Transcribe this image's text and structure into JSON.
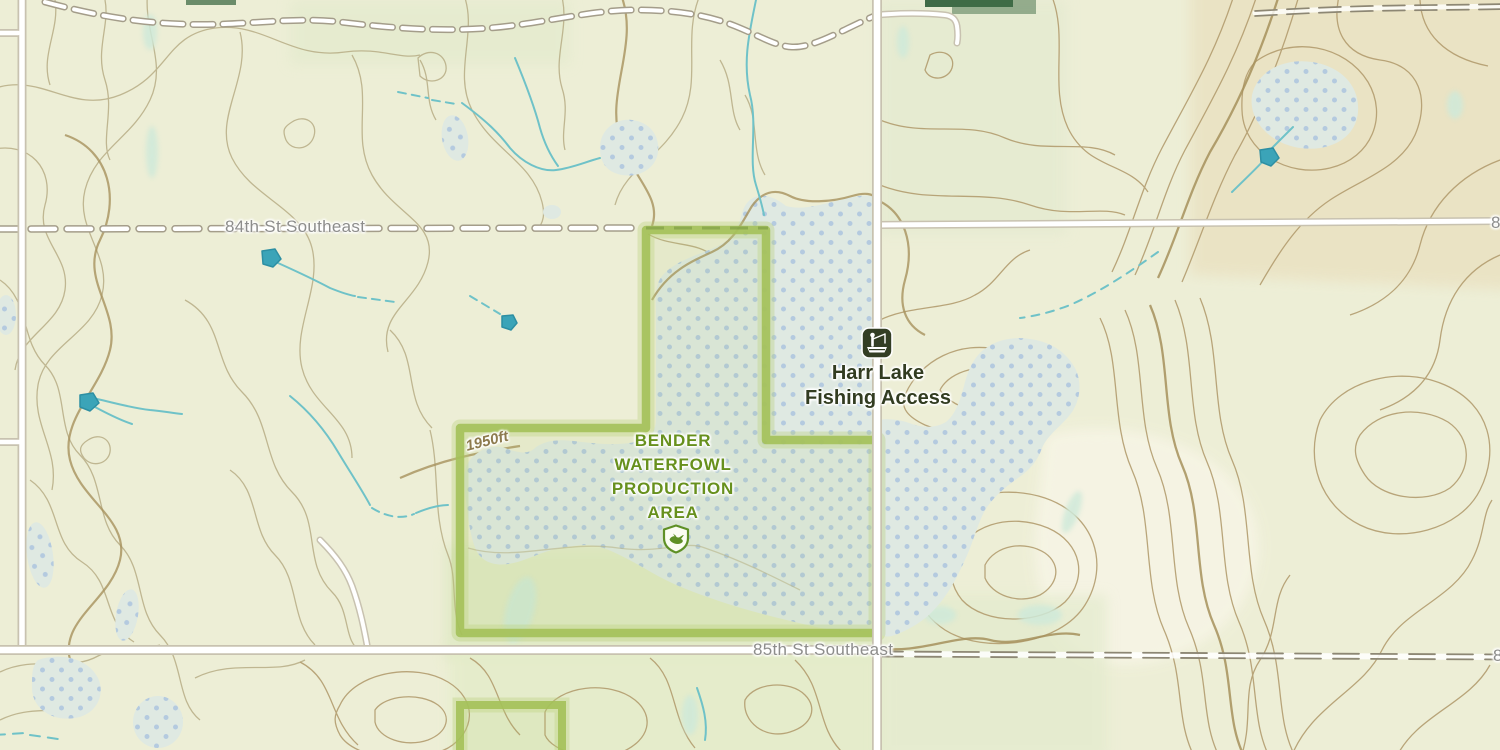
{
  "map": {
    "type": "topographic-map",
    "labels": {
      "street_84": "84th St Southeast",
      "street_85": "85th St Southeast",
      "street_84_partial": "84th St Southeast",
      "street_85_partial": "85th St Southeast",
      "contour_elevation": "1950ft",
      "poi_fishing_line1": "Harr Lake",
      "poi_fishing_line2": "Fishing Access",
      "protected_area_line1": "BENDER",
      "protected_area_line2": "WATERFOWL",
      "protected_area_line3": "PRODUCTION",
      "protected_area_line4": "AREA"
    },
    "icons": [
      {
        "name": "fishing-access-icon",
        "meaning": "boat fishing access site"
      },
      {
        "name": "waterfowl-production-area-icon",
        "meaning": "duck shield - waterfowl production area"
      }
    ],
    "colors": {
      "background": "#edeed6",
      "contour_thin": "#b7ad85",
      "contour_index": "#a6915c",
      "contour_brown": "#b39d6f",
      "wetland_fill": "#dfe9e2",
      "wetland_dot": "#a9c2de",
      "marsh_patch": "#cfe9d9",
      "protected_area_border": "#a4c159",
      "road_fill": "#ffffff",
      "road_casing": "#c8c2b0",
      "road_dash": "#8d8774",
      "stream": "#6fc2c8",
      "pond_marker": "#3ba4b8",
      "street_label": "#8d8d8b",
      "poi_label": "#323c21",
      "area_label": "#67901d",
      "contour_label": "#8d7b4e",
      "forest_strip": "#3f6b46"
    }
  }
}
